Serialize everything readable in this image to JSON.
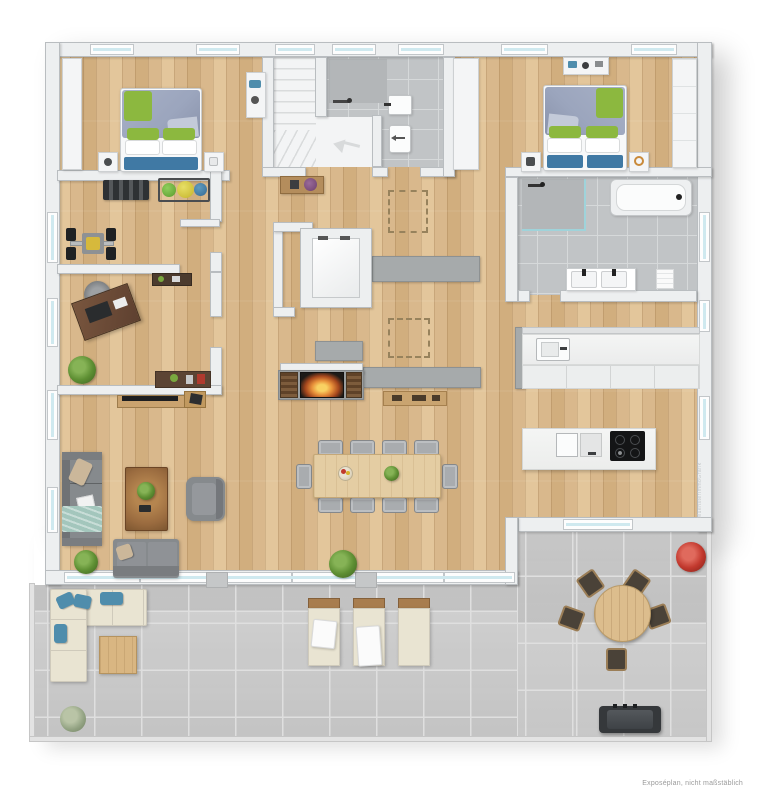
{
  "meta": {
    "caption": "Exposéplan, nicht maßstäblich",
    "watermark": "MuensterImmoGrafik"
  },
  "palette": {
    "wood": "#d9b88c",
    "wood_mid": "#d1ae7e",
    "wood_light": "#e3c69b",
    "terrace_tile": "#cbcbcb",
    "terrace_line": "#dfdfdf",
    "bath_tile": "#c1c4c6",
    "bath_line": "#d6d9da",
    "wall_fill": "#edeff0",
    "wall_edge": "#b9bdc0",
    "window_glass": "#cfe9ef",
    "slab_gray": "#a6aaab",
    "sofa_gray": "#868a8d",
    "bed_duvet": "#9ba5bd",
    "pillow_green": "#8cb83f",
    "bed_accent_blue": "#4079a4",
    "outdoor_cream": "#e9e4d2",
    "outdoor_blue": "#4f8dac",
    "table_wood": "#e4cda3",
    "dark_wood": "#6b4a33",
    "fire_orange": "#e8913a",
    "grill_dark": "#35383b",
    "plant_green": "#5e8f33",
    "plant_red": "#c2392e",
    "caption_gray": "#9b9b9b"
  },
  "rooms": [
    "bedroom-1",
    "fitness-room",
    "office",
    "stairwell",
    "shower-wc",
    "hallway",
    "bedroom-2",
    "bathroom",
    "kitchen",
    "living-dining-area",
    "elevator",
    "terrace"
  ]
}
